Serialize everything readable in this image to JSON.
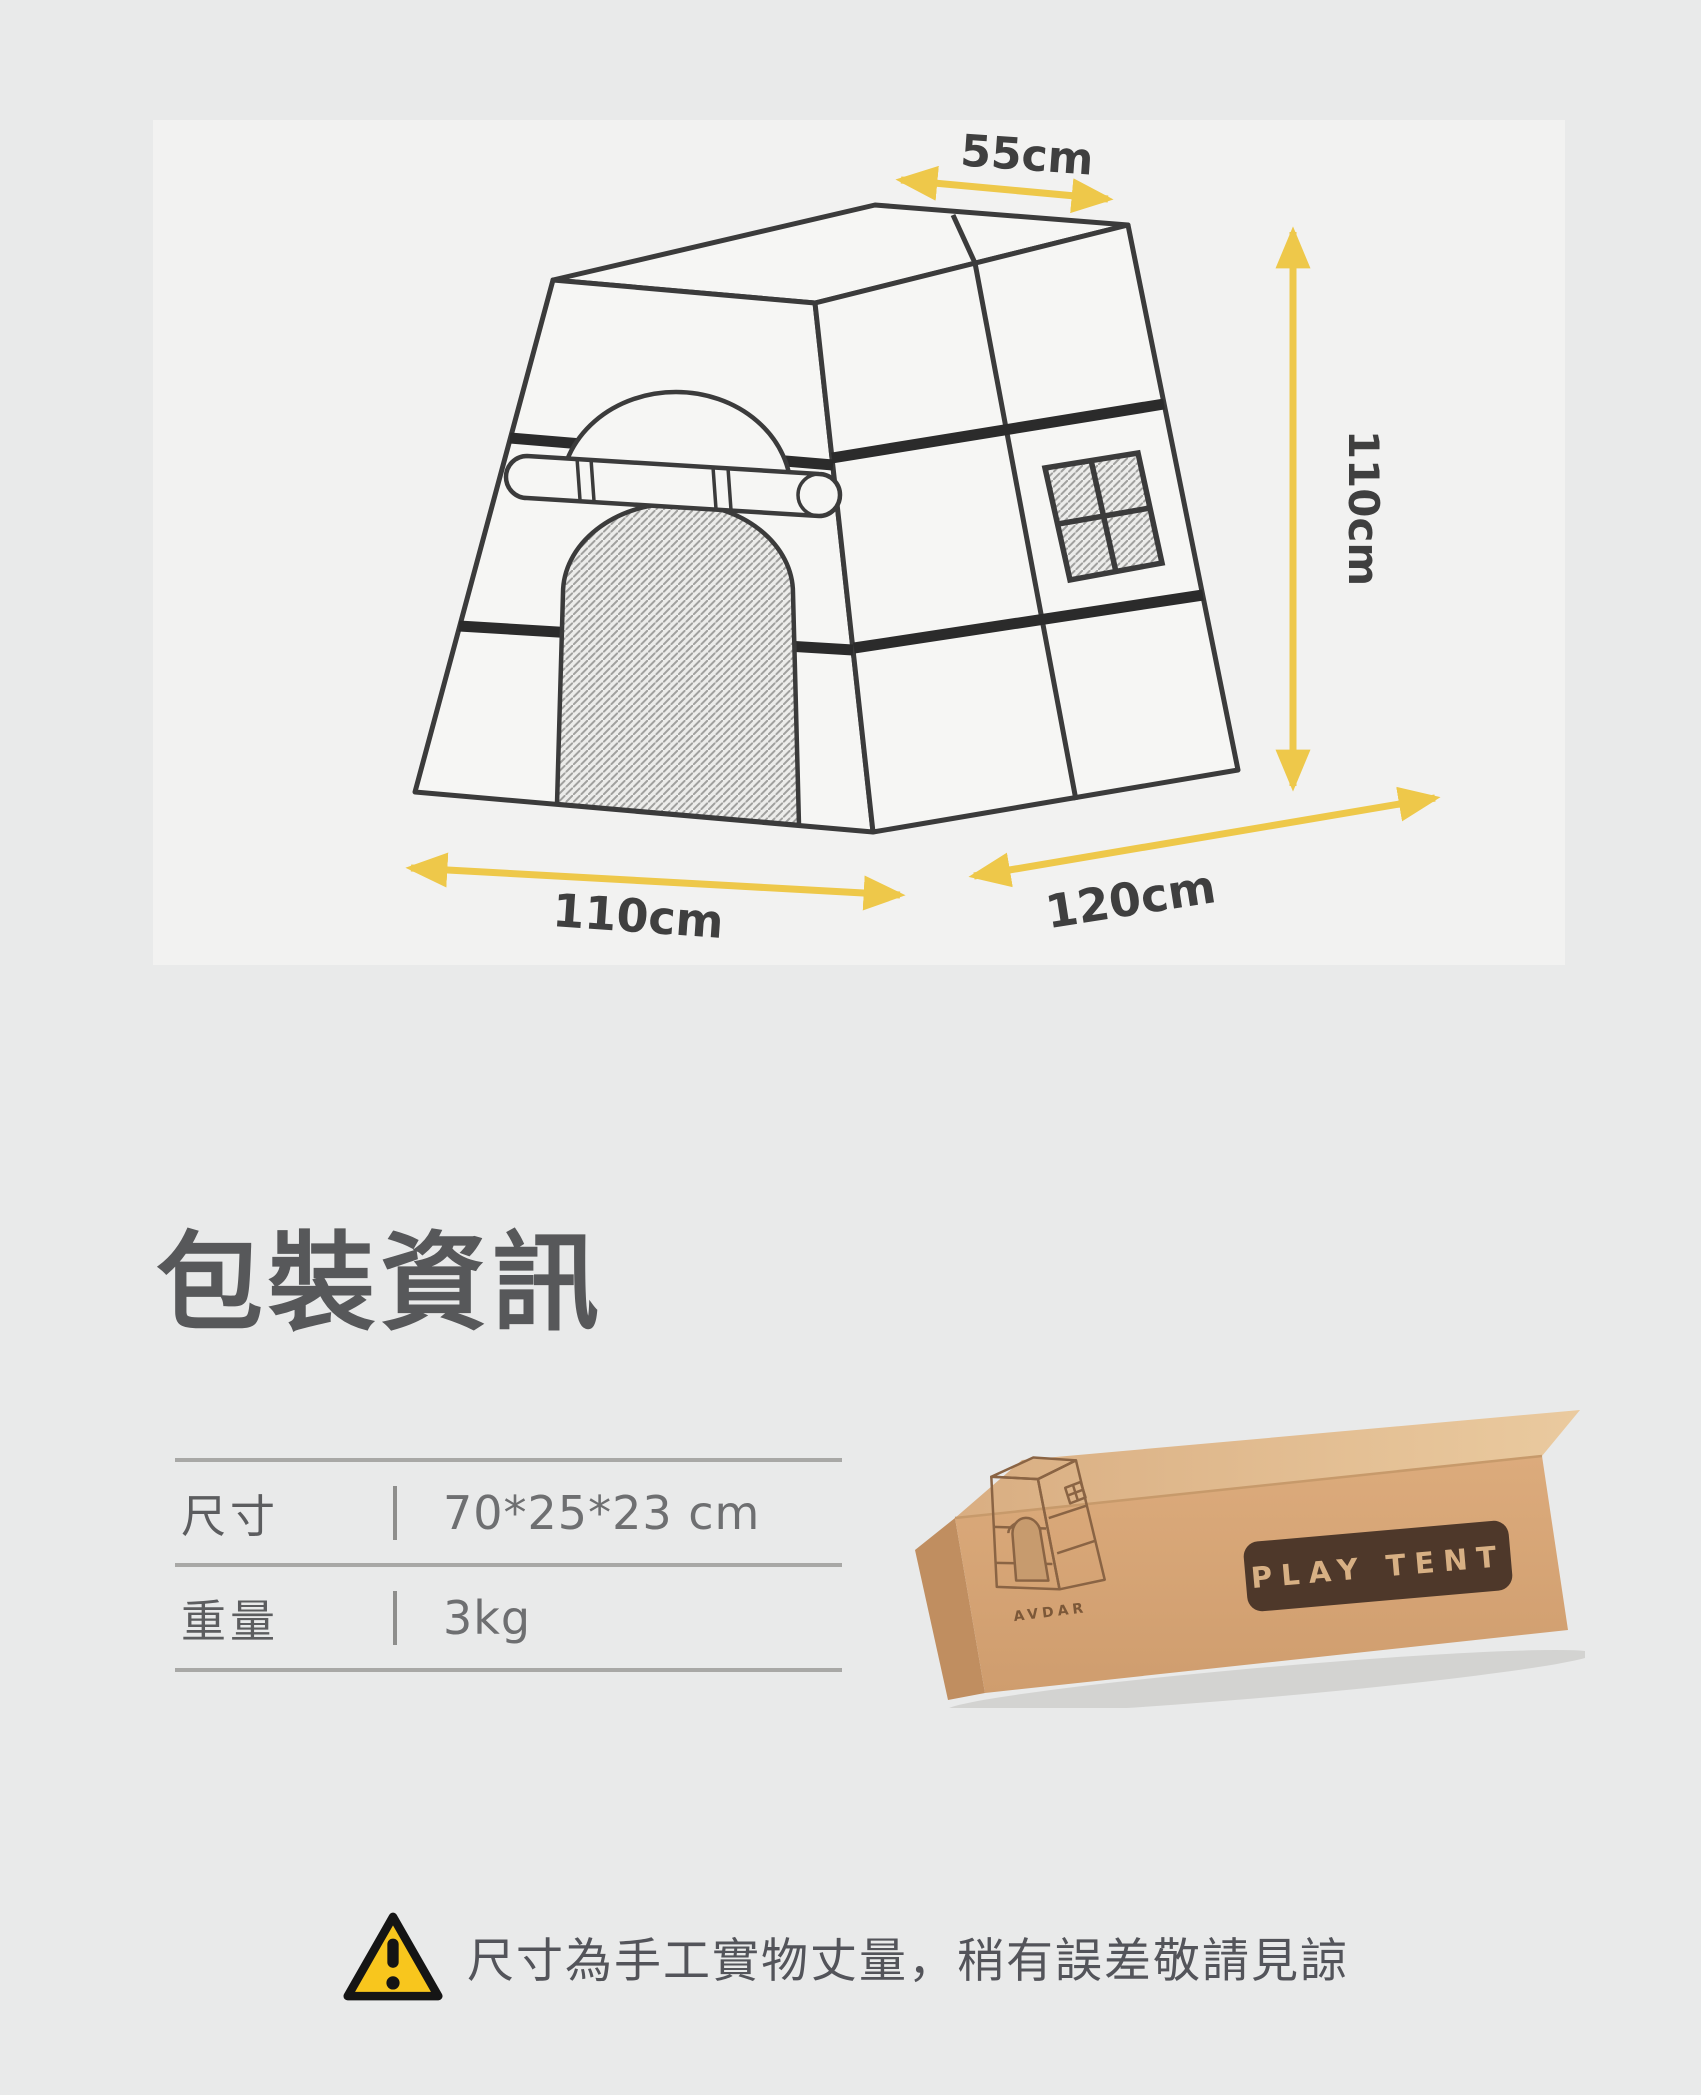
{
  "diagram": {
    "labels": {
      "top_width": "55cm",
      "height": "110cm",
      "front_width": "110cm",
      "depth": "120cm"
    },
    "accent_color": "#eec84a",
    "line_color": "#3b3b3b"
  },
  "packaging": {
    "heading": "包裝資訊",
    "table": {
      "rows": [
        {
          "label": "尺寸",
          "value": "70*25*23 cm"
        },
        {
          "label": "重量",
          "value": "3kg"
        }
      ]
    },
    "box_photo": {
      "print_label": "PLAY TENT",
      "brand": "AVDAR"
    }
  },
  "notice": {
    "text": "尺寸為手工實物丈量，稍有誤差敬請見諒"
  },
  "colors": {
    "page_background": "#e9eaea",
    "panel_background": "#f2f2f1",
    "heading_text": "#57585a",
    "warning_yellow": "#f8c61d",
    "carton_tan": "#d9a878",
    "label_brown": "#4e382a"
  }
}
